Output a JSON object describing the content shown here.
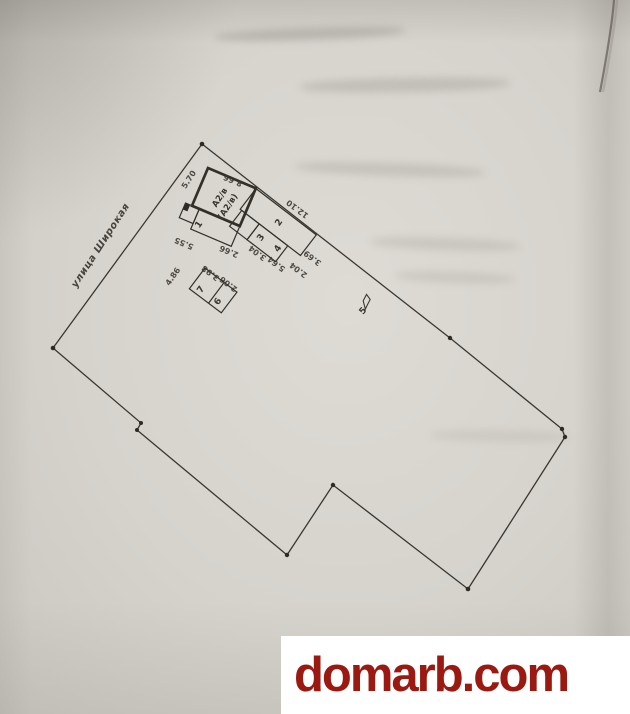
{
  "photo": {
    "street_label": "улица Широкая",
    "marker_label": "5"
  },
  "buildings": {
    "main_label_line1": "А2/в",
    "main_label_line2": "(А2/в)",
    "rooms": {
      "r1": "1",
      "r2": "2",
      "r3": "3",
      "r4": "4",
      "r6": "6",
      "r7": "7"
    }
  },
  "dimensions": {
    "d570": "5.70",
    "d866": "8.66",
    "d1210": "12.10",
    "d555": "5.55",
    "d266": "2.66",
    "d304": "3.04",
    "d564": "5.64",
    "d204": "2.04",
    "d369": "3.69",
    "d486": "4.86",
    "d398": "3.98",
    "d206": "2.06"
  },
  "watermark": {
    "text": "domarb.com"
  },
  "colors": {
    "ink": "#3a3631",
    "paper": "#d6d3cd",
    "watermark_red": "#9a1a12",
    "watermark_bg": "#ffffff"
  }
}
